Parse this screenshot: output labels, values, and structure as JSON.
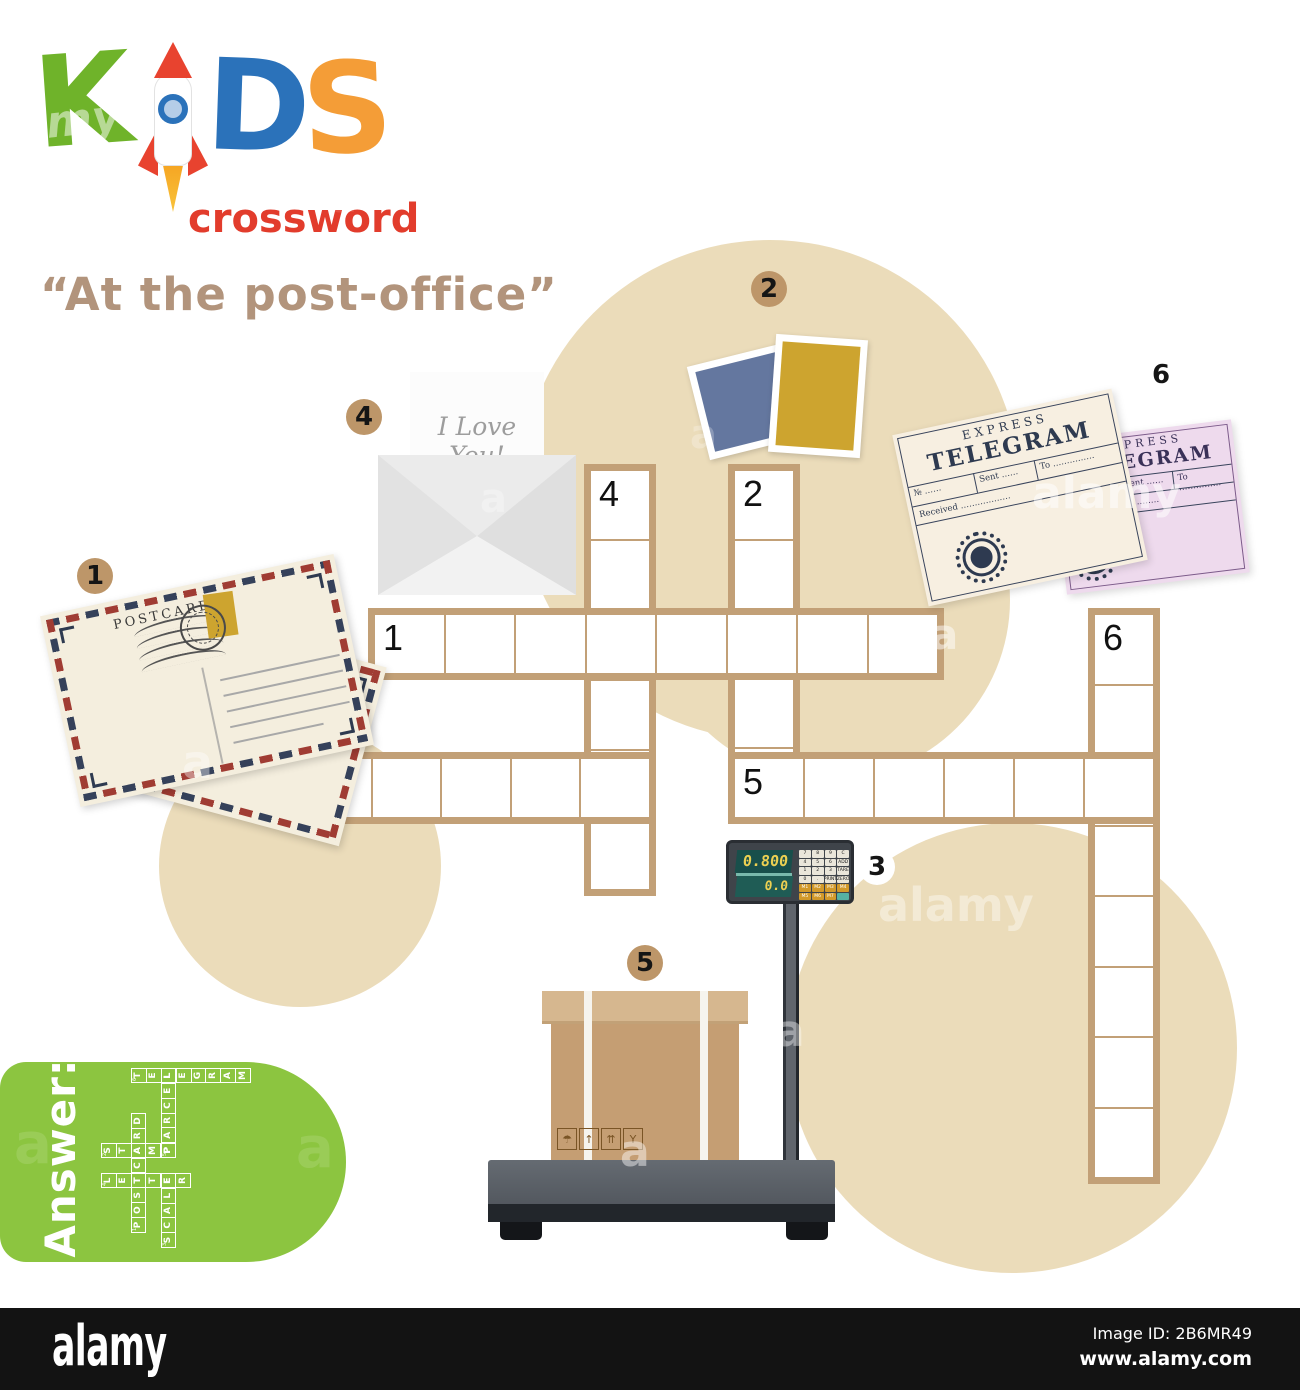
{
  "logo": {
    "letters": {
      "k": "K",
      "d": "D",
      "s": "S"
    },
    "sub": "crossword",
    "watermark_my": "my"
  },
  "title": "“At the post-office”",
  "colors": {
    "beige_blob": "#ebdcba",
    "green_blob": "#8cc540",
    "grid_border": "#c2a077",
    "marker_tan": "#bd9669",
    "logo_green": "#6fb32a",
    "logo_blue": "#2b72ba",
    "logo_orange": "#f49d37",
    "rocket_red": "#e8432f",
    "crossword_red": "#e23c2c",
    "title_tan": "#b2947c",
    "stamp_blue": "#64779f",
    "stamp_gold": "#cda42f",
    "telegram_pink": "#eedaed",
    "telegram_cream": "#f7efe1"
  },
  "blobs": [
    {
      "cx": 770,
      "cy": 490,
      "r": 250
    },
    {
      "cx": 830,
      "cy": 600,
      "r": 180
    },
    {
      "cx": 300,
      "cy": 866,
      "r": 141
    },
    {
      "cx": 1012,
      "cy": 1048,
      "r": 225
    }
  ],
  "crossword": {
    "origin": {
      "x": 296,
      "y": 464
    },
    "cell": 72,
    "runs": [
      {
        "num": "1",
        "dir": "across",
        "col": 1,
        "row": 2,
        "len": 8,
        "answer": "POSTCARD"
      },
      {
        "num": "2",
        "dir": "down",
        "col": 6,
        "row": 0,
        "len": 5,
        "answer": "STAMP"
      },
      {
        "num": "3",
        "dir": "across",
        "col": 0,
        "row": 4,
        "len": 5,
        "answer": "SCALE"
      },
      {
        "num": "4",
        "dir": "down",
        "col": 4,
        "row": 0,
        "len": 6,
        "answer": "LETTER"
      },
      {
        "num": "5",
        "dir": "across",
        "col": 6,
        "row": 4,
        "len": 6,
        "answer": "PARCEL"
      },
      {
        "num": "6",
        "dir": "down",
        "col": 11,
        "row": 2,
        "len": 8,
        "answer": "TELEGRAM"
      }
    ]
  },
  "answer_key": {
    "label": "Answer:",
    "cell": 15
  },
  "markers": [
    {
      "num": "1",
      "cx": 95,
      "cy": 576,
      "fill": "tan"
    },
    {
      "num": "2",
      "cx": 769,
      "cy": 289,
      "fill": "tan"
    },
    {
      "num": "3",
      "cx": 877,
      "cy": 867,
      "fill": "white"
    },
    {
      "num": "4",
      "cx": 364,
      "cy": 417,
      "fill": "tan"
    },
    {
      "num": "5",
      "cx": 645,
      "cy": 963,
      "fill": "tan"
    },
    {
      "num": "6",
      "cx": 1161,
      "cy": 375,
      "fill": "white"
    }
  ],
  "postcard": {
    "label": "POSTCARD"
  },
  "envelope": {
    "line1": "I Love",
    "line2": "You!"
  },
  "telegram": {
    "express": "EXPRESS",
    "title": "TELEGRAM",
    "no": "№ ……",
    "sent": "Sent ……",
    "to": "To ……………",
    "received": "Received ………………"
  },
  "scale_device": {
    "weight": "0.800",
    "tare": "0.0",
    "keys": [
      [
        "7",
        "8",
        "9",
        "C"
      ],
      [
        "4",
        "5",
        "6",
        "ADD"
      ],
      [
        "1",
        "2",
        "3",
        "TARE"
      ],
      [
        "0",
        ".",
        "PRINT",
        "ZERO"
      ],
      [
        "M1",
        "M2",
        "M3",
        "M4"
      ],
      [
        "M5",
        "M6",
        "M7",
        ""
      ]
    ]
  },
  "parcel": {
    "icons": [
      "☂",
      "↑",
      "⇈",
      "Y"
    ]
  },
  "watermarks": [
    {
      "text": "alamy",
      "x": 1032,
      "y": 468,
      "size": 44,
      "opacity": 0.55
    },
    {
      "text": "alamy",
      "x": 878,
      "y": 878,
      "size": 46,
      "opacity": 0.4
    },
    {
      "text": "a",
      "x": 182,
      "y": 735,
      "size": 46,
      "opacity": 0.4
    },
    {
      "text": "a",
      "x": 930,
      "y": 610,
      "size": 42,
      "opacity": 0.5
    },
    {
      "text": "a",
      "x": 620,
      "y": 1126,
      "size": 44,
      "opacity": 0.45
    },
    {
      "text": "a",
      "x": 775,
      "y": 1006,
      "size": 44,
      "opacity": 0.4
    },
    {
      "text": "a",
      "x": 480,
      "y": 476,
      "size": 40,
      "opacity": 0.3
    },
    {
      "text": "a",
      "x": 690,
      "y": 412,
      "size": 40,
      "opacity": 0.25
    },
    {
      "text": "a",
      "x": 940,
      "y": 70,
      "size": 40,
      "opacity": 0.15
    },
    {
      "text": "a",
      "x": 14,
      "y": 1112,
      "size": 56,
      "opacity": 0.12
    },
    {
      "text": "a",
      "x": 296,
      "y": 1116,
      "size": 56,
      "opacity": 0.12
    },
    {
      "text": "a",
      "x": 330,
      "y": 176,
      "size": 40,
      "opacity": 0.1
    }
  ],
  "footer": {
    "brand": "alamy",
    "image_id": "Image ID: 2B6MR49",
    "url": "www.alamy.com"
  }
}
